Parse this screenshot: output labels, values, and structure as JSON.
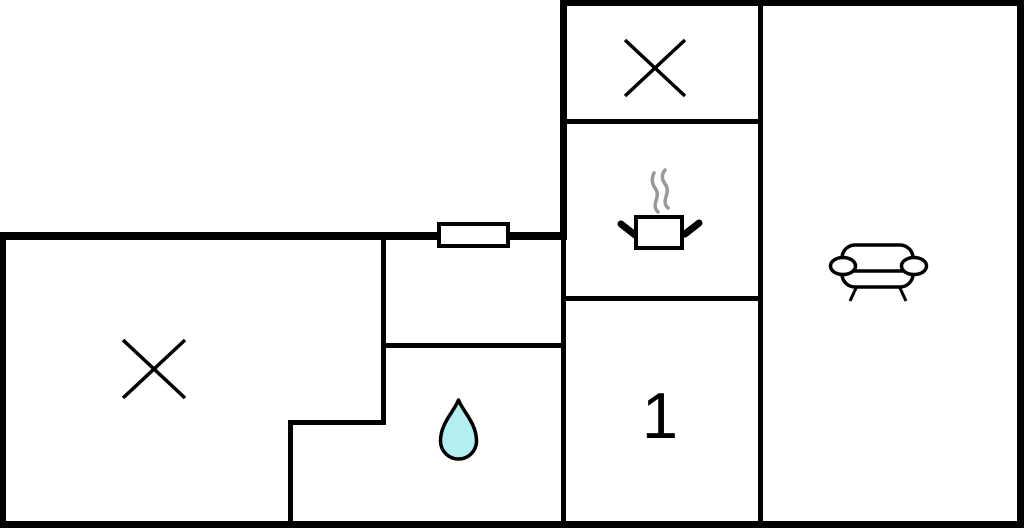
{
  "colors": {
    "background": "#ffffff",
    "wall": "#000000",
    "icon_stroke": "#000000",
    "water_drop_fill": "#b2eef2",
    "steam_gray": "#999999"
  },
  "labels": {
    "room_1": "1"
  },
  "rooms": [
    {
      "id": "top-right-room",
      "symbol": "cross-icon",
      "label": ""
    },
    {
      "id": "kitchen",
      "symbol": "cooking-pot-icon",
      "label": ""
    },
    {
      "id": "living-room",
      "symbol": "sofa-icon",
      "label": ""
    },
    {
      "id": "room-1",
      "symbol": "none",
      "label": "1"
    },
    {
      "id": "left-room",
      "symbol": "cross-icon",
      "label": ""
    },
    {
      "id": "bathroom",
      "symbol": "water-drop-icon",
      "label": ""
    }
  ]
}
